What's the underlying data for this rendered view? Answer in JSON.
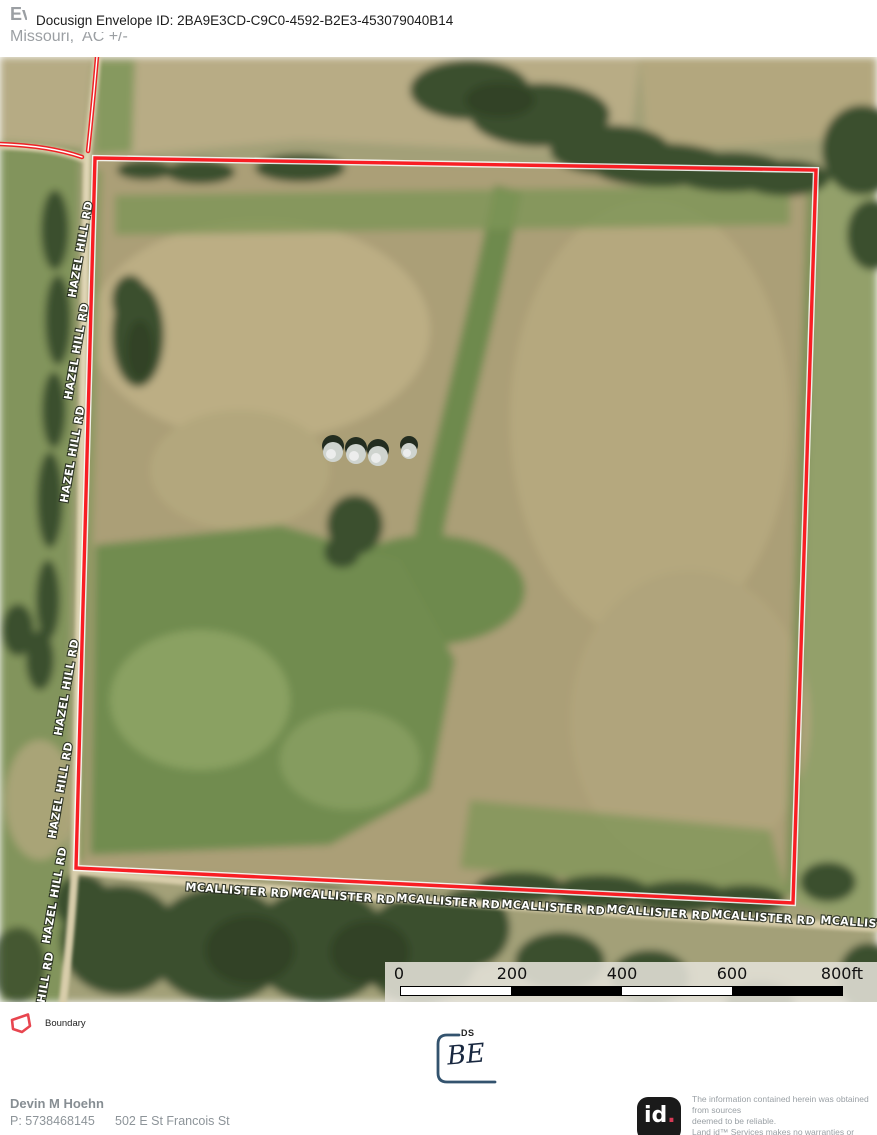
{
  "header": {
    "client_name": "Evans",
    "docusign_banner": "Docusign Envelope ID: 2BA9E3CD-C9C0-4592-B2E3-453079040B14",
    "subtitle": "Missouri,  AC +/-"
  },
  "map": {
    "boundary_color": "#f81e24",
    "road_labels": [
      {
        "text": "HAZEL HILL RD",
        "x": 84,
        "y": 250,
        "rotate": -80
      },
      {
        "text": "HAZEL HILL RD",
        "x": 80,
        "y": 352,
        "rotate": -80
      },
      {
        "text": "HAZEL HILL RD",
        "x": 76,
        "y": 455,
        "rotate": -80
      },
      {
        "text": "HAZEL HILL RD",
        "x": 70,
        "y": 688,
        "rotate": -80
      },
      {
        "text": "HAZEL HILL RD",
        "x": 64,
        "y": 791,
        "rotate": -80
      },
      {
        "text": "HAZEL HILL RD",
        "x": 58,
        "y": 896,
        "rotate": -80
      },
      {
        "text": "HILL RD",
        "x": 49,
        "y": 978,
        "rotate": -80
      },
      {
        "text": "MCALLISTER RD",
        "x": 237,
        "y": 894,
        "rotate": 4
      },
      {
        "text": "MCALLISTER RD",
        "x": 343,
        "y": 900,
        "rotate": 4
      },
      {
        "text": "MCALLISTER RD",
        "x": 448,
        "y": 905,
        "rotate": 4
      },
      {
        "text": "MCALLISTER RD",
        "x": 553,
        "y": 911,
        "rotate": 4
      },
      {
        "text": "MCALLISTER RD",
        "x": 658,
        "y": 916,
        "rotate": 4
      },
      {
        "text": "MCALLISTER RD",
        "x": 763,
        "y": 921,
        "rotate": 4
      },
      {
        "text": "MCALLISTER RD",
        "x": 872,
        "y": 927,
        "rotate": 4
      }
    ],
    "grain_bins": [
      {
        "x": 333,
        "y": 450,
        "r": 10
      },
      {
        "x": 356,
        "y": 452,
        "r": 10
      },
      {
        "x": 378,
        "y": 454,
        "r": 10
      },
      {
        "x": 409,
        "y": 449,
        "r": 8
      }
    ]
  },
  "scale_bar": {
    "ticks": [
      "0",
      "200",
      "400",
      "600",
      "800ft"
    ]
  },
  "legend": {
    "boundary_label": "Boundary",
    "boundary_color": "#e8454f"
  },
  "stamp": {
    "label": "DS",
    "initials": "BE"
  },
  "footer": {
    "agent_name": "Devin M Hoehn",
    "phone": "P: 5738468145",
    "address": "502 E St Francois St",
    "logo_id": "id",
    "logo_dot": ".",
    "disclaimer": "The information contained herein was obtained from sources\ndeemed to be reliable.\n Land id™ Services makes no warranties or guarantees as to the\ncompleteness or accuracy thereof."
  }
}
